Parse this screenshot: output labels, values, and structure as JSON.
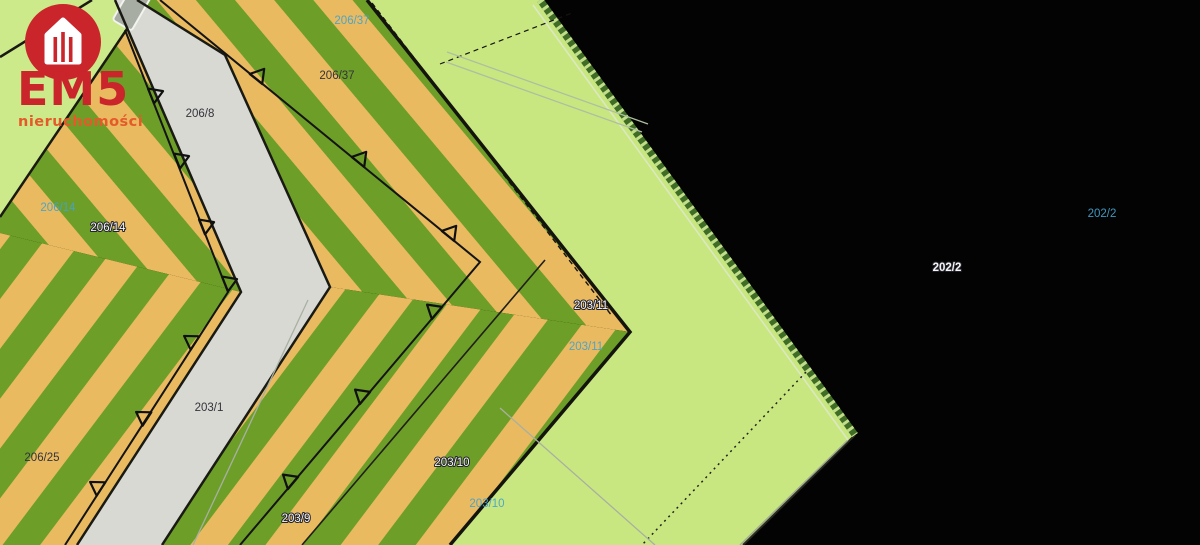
{
  "logo": {
    "brand": "EM5",
    "tagline": "nieruchomości"
  },
  "palette": {
    "parcel_light_green": "#c9e781",
    "stripe_green": "#6d9e28",
    "stripe_tan": "#e9ba60",
    "road_gray": "#d8d9d3",
    "background_black": "#030304",
    "boundary_black": "#16160f",
    "hatch_dark_green": "#3f6d26",
    "hatch_light_green": "#c2de8a",
    "label_blue": "#45a3cc",
    "label_dark": "#33333d",
    "label_white": "#f5f5f8",
    "logo_red": "#c9252b",
    "logo_orange": "#e55a2b"
  },
  "labels": [
    {
      "id": "parcel-206-8",
      "text": "206/8",
      "style": "dark"
    },
    {
      "id": "parcel-206-37",
      "text": "206/37",
      "style": "dark"
    },
    {
      "id": "parcel-206-37-blue",
      "text": "206/37",
      "style": "blue"
    },
    {
      "id": "parcel-206-14",
      "text": "206/14",
      "style": "white"
    },
    {
      "id": "parcel-206-14-blue",
      "text": "206/14",
      "style": "blue"
    },
    {
      "id": "parcel-203-11",
      "text": "203/11",
      "style": "white"
    },
    {
      "id": "parcel-203-11-blue",
      "text": "203/11",
      "style": "blue"
    },
    {
      "id": "parcel-203-1",
      "text": "203/1",
      "style": "dark"
    },
    {
      "id": "parcel-206-25",
      "text": "206/25",
      "style": "dark"
    },
    {
      "id": "parcel-203-10",
      "text": "203/10",
      "style": "white"
    },
    {
      "id": "parcel-203-10-blue",
      "text": "203/10",
      "style": "blue"
    },
    {
      "id": "parcel-203-9",
      "text": "203/9",
      "style": "white"
    },
    {
      "id": "parcel-202-2-blue",
      "text": "202/2",
      "style": "blue"
    },
    {
      "id": "parcel-202-2",
      "text": "202/2",
      "style": "white"
    }
  ]
}
